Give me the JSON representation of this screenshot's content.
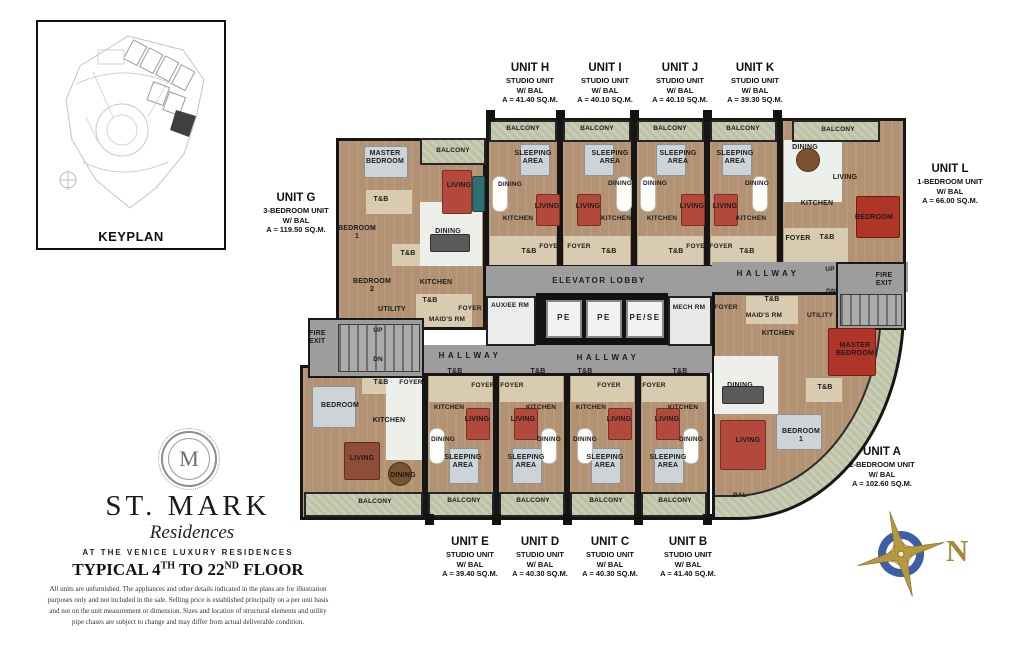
{
  "keyplan": {
    "label": "KEYPLAN"
  },
  "brand": {
    "monogram": "M",
    "name": "ST. MARK",
    "script": "Residences",
    "tagline": "AT THE VENICE LUXURY RESIDENCES",
    "floor": {
      "p1": "TYPICAL 4",
      "s1": "TH",
      "p2": " TO 22",
      "s2": "ND",
      "p3": " FLOOR"
    },
    "disclaimer_lines": [
      "All units are unfurnished. The appliances and other details indicated in the plans are for illustration",
      "purposes only and not included in the sale. Selling price is established principally on a per unit basis",
      "and not on the unit measurement or dimension. Sizes and location of structural elements and utility",
      "pipe chases are subject to change and may differ from actual deliverable condition."
    ]
  },
  "compass": {
    "north": "N"
  },
  "rooms": {
    "balcony": "BALCONY",
    "bal": "BAL",
    "sleeping": "SLEEPING AREA",
    "dining": "DINING",
    "living": "LIVING",
    "kitchen": "KITCHEN",
    "tb": "T&B",
    "foyer": "FOYER",
    "master": "MASTER BEDROOM",
    "bedroom": "BEDROOM",
    "bedroom1": "BEDROOM 1",
    "bedroom2": "BEDROOM 2",
    "utility": "UTILITY",
    "maids": "MAID'S RM"
  },
  "core": {
    "lobby": "ELEVATOR LOBBY",
    "hallway": "HALLWAY",
    "aux": "AUX/EE RM",
    "mech": "MECH RM",
    "fire": "FIRE EXIT",
    "up": "UP",
    "dn": "DN",
    "lifts": [
      "PE",
      "PE",
      "PE/SE"
    ]
  },
  "callouts": {
    "unit_g": {
      "name": "UNIT G",
      "type": "3-BEDROOM UNIT",
      "bal": "W/ BAL",
      "area": "A = 119.50 SQ.M."
    },
    "unit_h": {
      "name": "UNIT H",
      "type": "STUDIO UNIT",
      "bal": "W/ BAL",
      "area": "A = 41.40 SQ.M."
    },
    "unit_i": {
      "name": "UNIT I",
      "type": "STUDIO UNIT",
      "bal": "W/ BAL",
      "area": "A = 40.10 SQ.M."
    },
    "unit_j": {
      "name": "UNIT J",
      "type": "STUDIO UNIT",
      "bal": "W/ BAL",
      "area": "A = 40.10 SQ.M."
    },
    "unit_k": {
      "name": "UNIT K",
      "type": "STUDIO UNIT",
      "bal": "W/ BAL",
      "area": "A = 39.30 SQ.M."
    },
    "unit_l": {
      "name": "UNIT L",
      "type": "1-BEDROOM UNIT",
      "bal": "W/ BAL",
      "area": "A = 66.00 SQ.M."
    },
    "unit_a": {
      "name": "UNIT A",
      "type": "2-BEDROOM UNIT",
      "bal": "W/ BAL",
      "area": "A = 102.60 SQ.M."
    },
    "unit_b": {
      "name": "UNIT B",
      "type": "STUDIO UNIT",
      "bal": "W/ BAL",
      "area": "A = 41.40 SQ.M."
    },
    "unit_c": {
      "name": "UNIT C",
      "type": "STUDIO UNIT",
      "bal": "W/ BAL",
      "area": "A = 40.30 SQ.M."
    },
    "unit_d": {
      "name": "UNIT D",
      "type": "STUDIO UNIT",
      "bal": "W/ BAL",
      "area": "A = 40.30 SQ.M."
    },
    "unit_e": {
      "name": "UNIT E",
      "type": "STUDIO UNIT",
      "bal": "W/ BAL",
      "area": "A = 39.40 SQ.M."
    }
  },
  "colors": {
    "hallway_gray": "#9d9d9d",
    "wood_floor": "#b29272",
    "balcony_green": "#c9cdb2",
    "accent_red": "#b03427",
    "compass_gold": "#b5993f",
    "compass_blue": "#3c5fa8"
  }
}
